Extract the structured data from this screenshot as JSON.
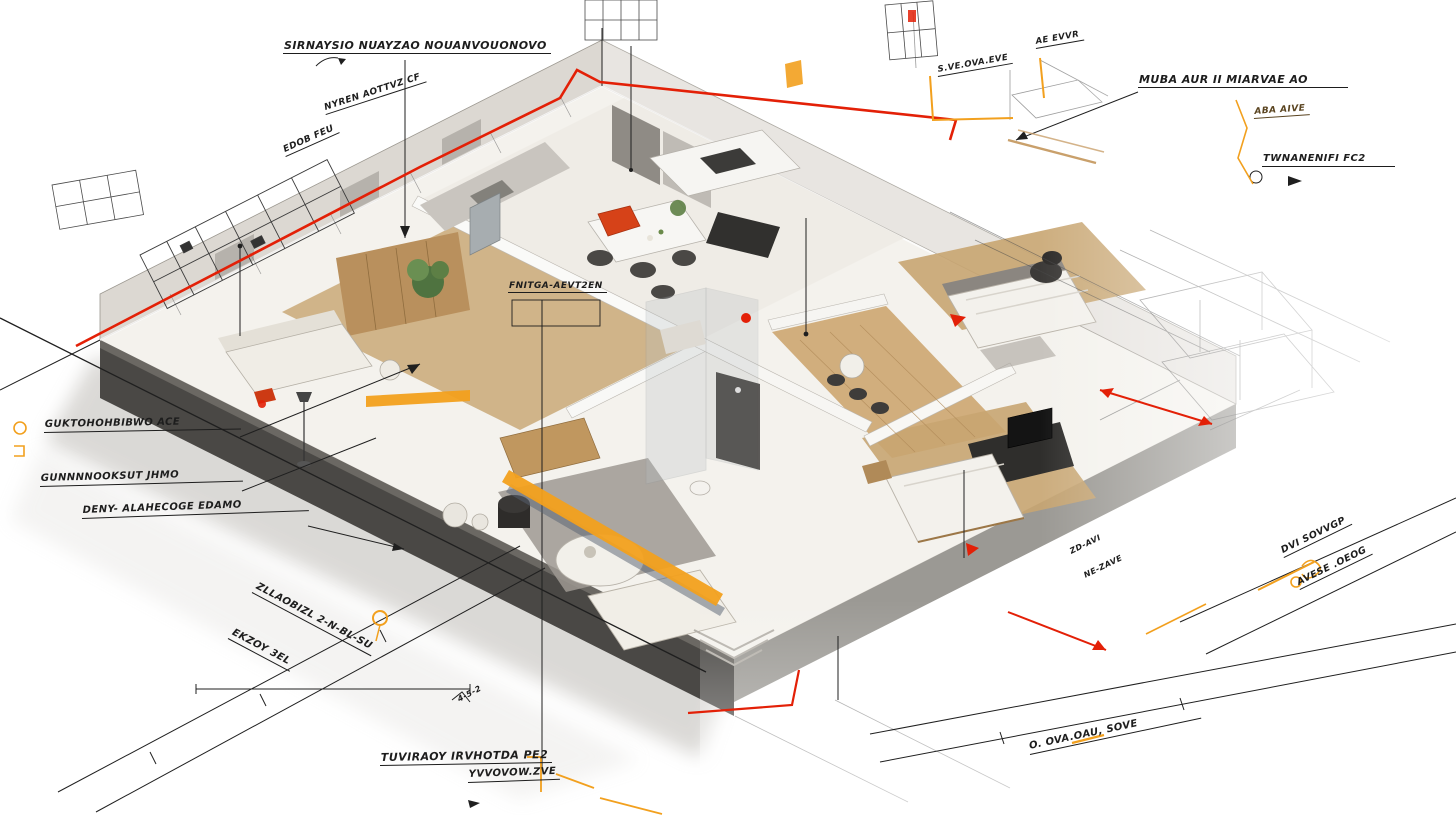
{
  "scene": {
    "type": "isometric-floorplan-blueprint",
    "background": "#ffffff"
  },
  "colors": {
    "annotation_red": "#e32007",
    "annotation_orange": "#f2a01e",
    "ink": "#1f1f1f",
    "wood": "#c8a571",
    "wood_dark": "#9c7747",
    "wall_light": "#dcd8d2",
    "wall_mid": "#b8b4ad",
    "facade_dark": "#4a4845",
    "floor_cream": "#f4f2ed",
    "rug_gray": "#9d9992",
    "accent_chair_red": "#d64218",
    "plant_green": "#5d7f45",
    "steel": "#a7adb0"
  },
  "labels": {
    "top_left_title": "SIRNAYSIO NUAYZAO NOUANVOUONOVO",
    "tl_diag1": "NYREN AOTTVZ CF",
    "tl_diag2": "EDOB FEU",
    "tc_small1": "S.VE.OVA.EVE",
    "tc_small2": "AE EVVR",
    "tr_title": "MUBA AUR II MIARVAE AO",
    "tr_small": "ABA AIVE",
    "r_upper": "TWNANENIFI FC2",
    "l_mid1": "GUKTOHOHBIBWO ACE",
    "l_mid2": "GUNNNNOOKSUT JHMO",
    "l_mid3": "DENY- ALAHECOGE EDAMO",
    "mid_plan": "FNITGA-AEVT2EN",
    "bl_diag1": "EKZOY 3EL",
    "bl_diag2": "ZLLAOBIZL 2-N-BL-SU",
    "b_center1": "TUVIRAOY IRVHOTDA PE2",
    "b_center2": "YVVOVOW.ZVE",
    "br_diag": "O. OVA.OAU, SOVE",
    "r_lower1": "DVI SOVVGP",
    "r_lower2": "AVESE .OEOG",
    "dim_note": "4-5-2",
    "tiny_r1": "ZD-AVI",
    "tiny_r2": "NE-ZAVE"
  },
  "icons": {
    "pen_arrow": "handwritten arrow flourish",
    "circle_marker": "open circle marker",
    "lamp_squiggle": "orange lamp sketch",
    "red_arrow": "red leader arrow"
  }
}
